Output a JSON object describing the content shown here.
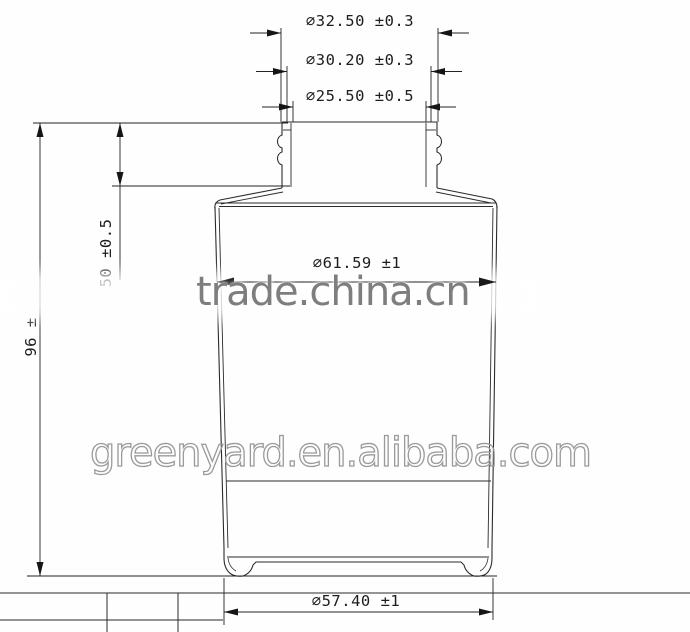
{
  "drawing": {
    "type": "bottle-technical-drawing",
    "dim_labels": {
      "neck_outer": "∅32.50 ±0.3",
      "neck_mid": "∅30.20 ±0.3",
      "neck_inner": "∅25.50 ±0.5",
      "body": "∅61.59 ±1",
      "base": "∅57.40 ±1",
      "total_height": "96 ±",
      "neck_height": "50 ±0.5"
    },
    "watermarks": {
      "center": "trade.china.cn",
      "lower": "greenyard.en.alibaba.com"
    },
    "colors": {
      "line": "#2b2b2b",
      "dim_line": "#222222",
      "watermark_center": "#7e7e7e",
      "watermark_lower_outline": "#9a9a9a",
      "background": "#fefefe"
    }
  }
}
